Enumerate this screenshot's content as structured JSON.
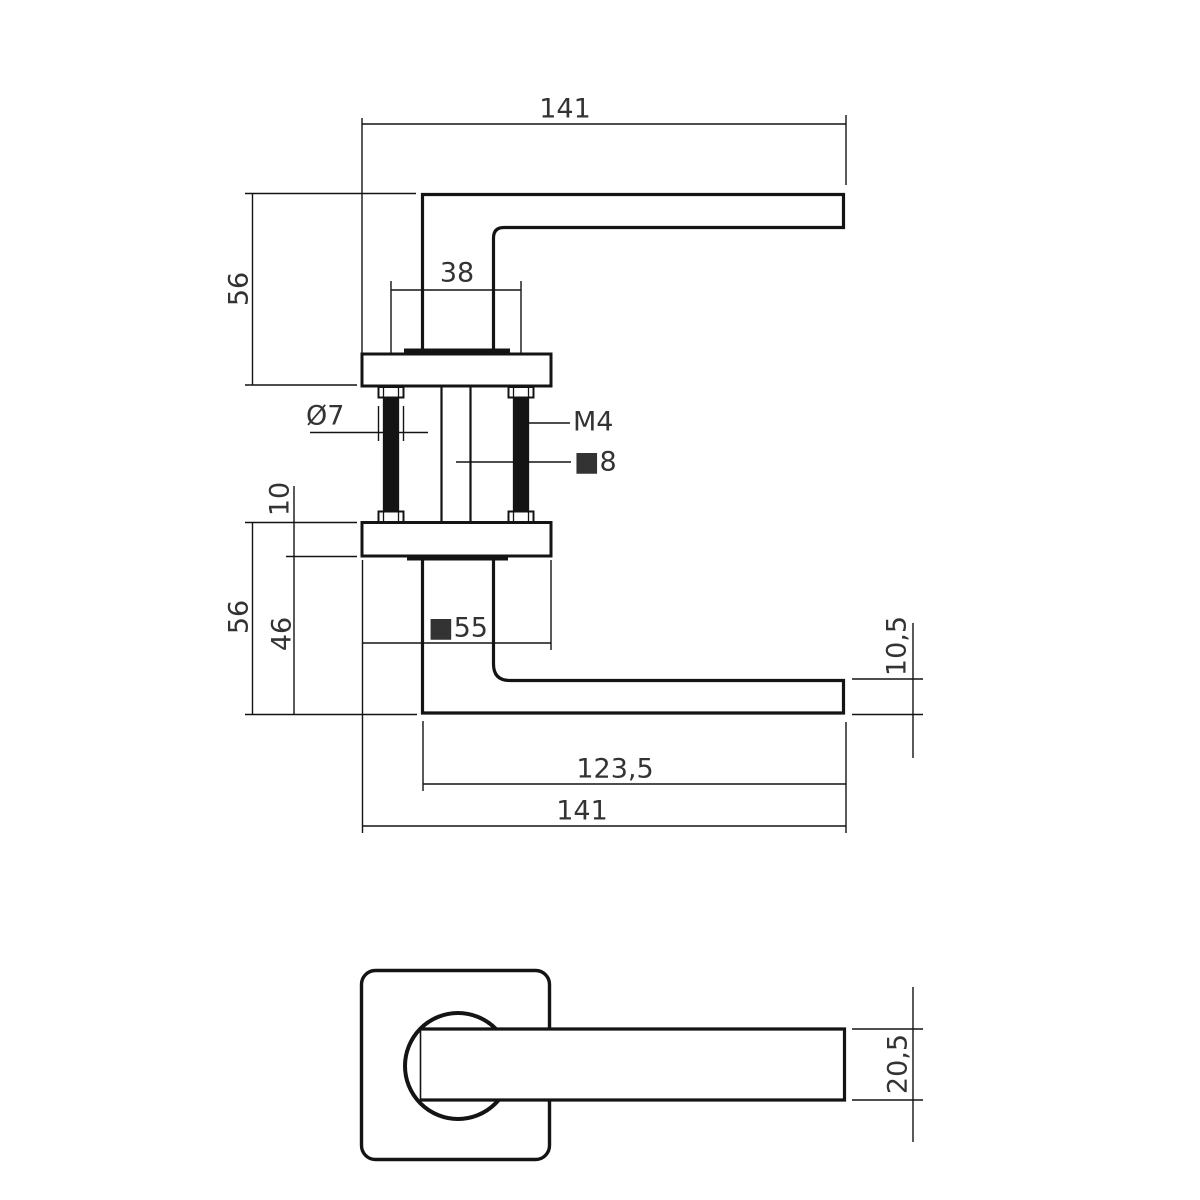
{
  "colors": {
    "background": "#ffffff",
    "line": "#141414",
    "text": "#333333"
  },
  "drawing": {
    "type": "technical-drawing",
    "subject": "door-handle-on-square-rose",
    "views": {
      "side_view_top": {
        "labels": {
          "length": "141",
          "height": "56",
          "screw_spacing": "38",
          "screw_head_dia": "Ø7",
          "thread": "M4",
          "spindle": "■8"
        }
      },
      "side_view_bottom": {
        "labels": {
          "rose_thickness": "10",
          "height": "56",
          "neck_height": "46",
          "rose_size": "■55",
          "lever_thickness": "10,5",
          "grip_length": "123,5",
          "length": "141"
        }
      },
      "front_view": {
        "labels": {
          "lever_width": "20,5"
        }
      }
    }
  }
}
